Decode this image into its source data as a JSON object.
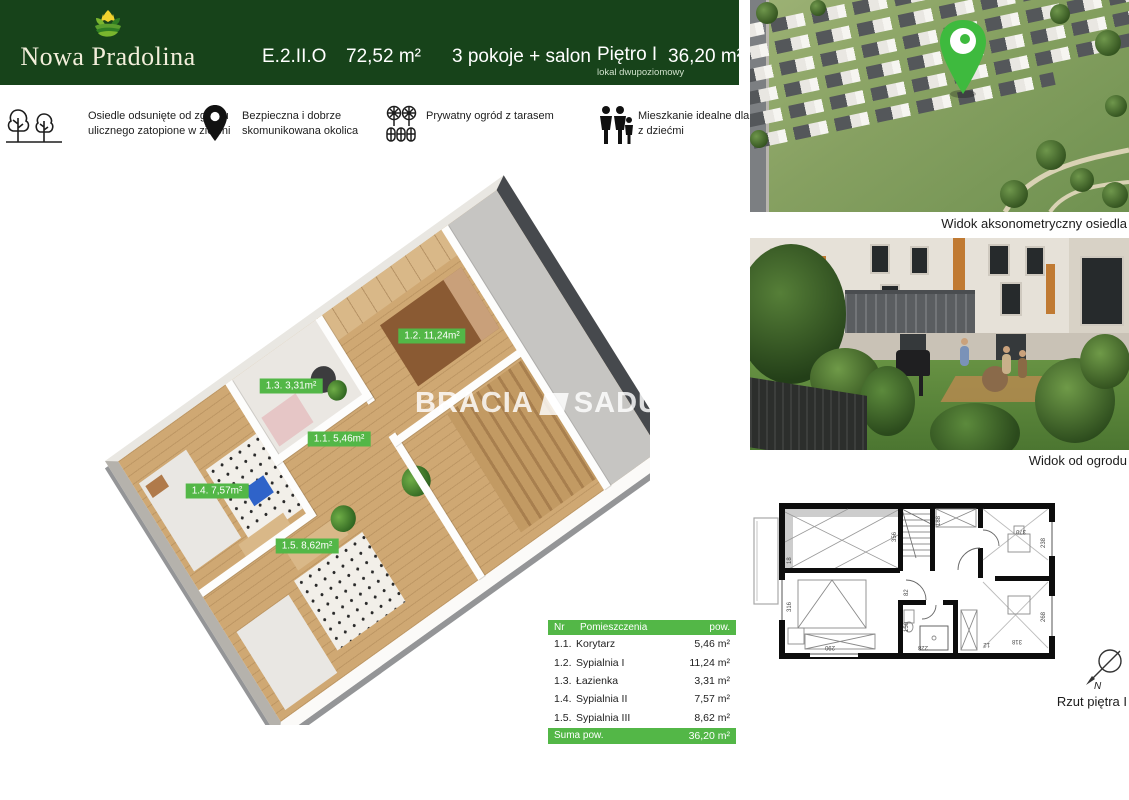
{
  "brand": {
    "name": "Nowa Pradolina"
  },
  "header": {
    "unit_code": "E.2.II.O",
    "total_area": "72,52 m²",
    "layout": "3 pokoje + salon",
    "floor": "Piętro I",
    "floor_note": "lokal dwupoziomowy",
    "floor_area": "36,20 m²"
  },
  "features": [
    {
      "icon": "trees-icon",
      "text": "Osiedle odsunięte od zgiełku ulicznego zatopione  w zieleni"
    },
    {
      "icon": "location-pin-icon",
      "text": "Bezpieczna i dobrze skomunikowana okolica"
    },
    {
      "icon": "garden-icon",
      "text": "Prywatny ogród z tarasem"
    },
    {
      "icon": "family-icon",
      "text": "Mieszkanie idealne dla rodzin z dziećmi"
    }
  ],
  "floorplan3d": {
    "watermark_left": "BRACIA",
    "watermark_right": "SADURSCY",
    "labels": [
      {
        "text": "1.2. 11,24m²"
      },
      {
        "text": "1.3. 3,31m²"
      },
      {
        "text": "1.1. 5,46m²"
      },
      {
        "text": "1.4. 7,57m²"
      },
      {
        "text": "1.5. 8,62m²"
      }
    ]
  },
  "rooms_table": {
    "col_nr": "Nr",
    "col_name": "Pomieszczenia",
    "col_area": "pow.",
    "rows": [
      {
        "nr": "1.1.",
        "name": "Korytarz",
        "area": "5,46 m²"
      },
      {
        "nr": "1.2.",
        "name": "Sypialnia I",
        "area": "11,24 m²"
      },
      {
        "nr": "1.3.",
        "name": "Łazienka",
        "area": "3,31 m²"
      },
      {
        "nr": "1.4.",
        "name": "Sypialnia II",
        "area": "7,57 m²"
      },
      {
        "nr": "1.5.",
        "name": "Sypialnia III",
        "area": "8,62 m²"
      }
    ],
    "total_label": "Suma pow.",
    "total_value": "36,20 m²"
  },
  "gallery": {
    "aerial_caption": "Widok aksonometryczny osiedla",
    "garden_caption": "Widok od ogrodu",
    "plan_caption": "Rzut piętra I",
    "compass_label": "N"
  },
  "plan2d": {
    "dims": [
      "316",
      "18",
      "290",
      "356",
      "150",
      "228",
      "12",
      "318",
      "268",
      "370",
      "238",
      "188",
      "82"
    ]
  },
  "colors": {
    "dark_green": "#17431a",
    "accent_green": "#53b747"
  }
}
